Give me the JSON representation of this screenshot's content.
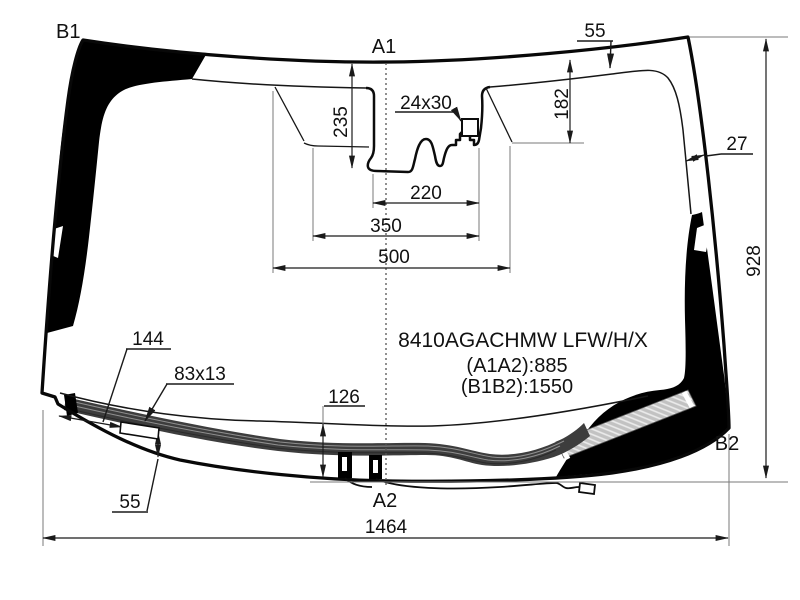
{
  "title": "Windshield technical diagram",
  "part": {
    "code": "8410AGACHMW LFW/H/X",
    "a1a2": "(A1A2):885",
    "b1b2": "(B1B2):1550"
  },
  "ref_points": {
    "top_left": "B1",
    "top_center": "A1",
    "bottom_center": "A2",
    "bottom_right": "B2"
  },
  "dimensions": {
    "top_band_width": "55",
    "right_band_width": "27",
    "glass_height": "928",
    "glass_width": "1464",
    "cutout_depth_left": "235",
    "cutout_depth_right": "182",
    "sensor_window": "24x30",
    "cutout_width_inner": "220",
    "cutout_width_mid": "350",
    "cutout_width_outer": "500",
    "heater_left_offset": "144",
    "heater_pad_size": "83x13",
    "heater_bottom_gap": "55",
    "bottom_band_height": "126"
  },
  "colors": {
    "line": "#111111",
    "frit": "#000000",
    "heater_band": "#3d3d3d",
    "wiper_pad": "#c2c2c2"
  }
}
